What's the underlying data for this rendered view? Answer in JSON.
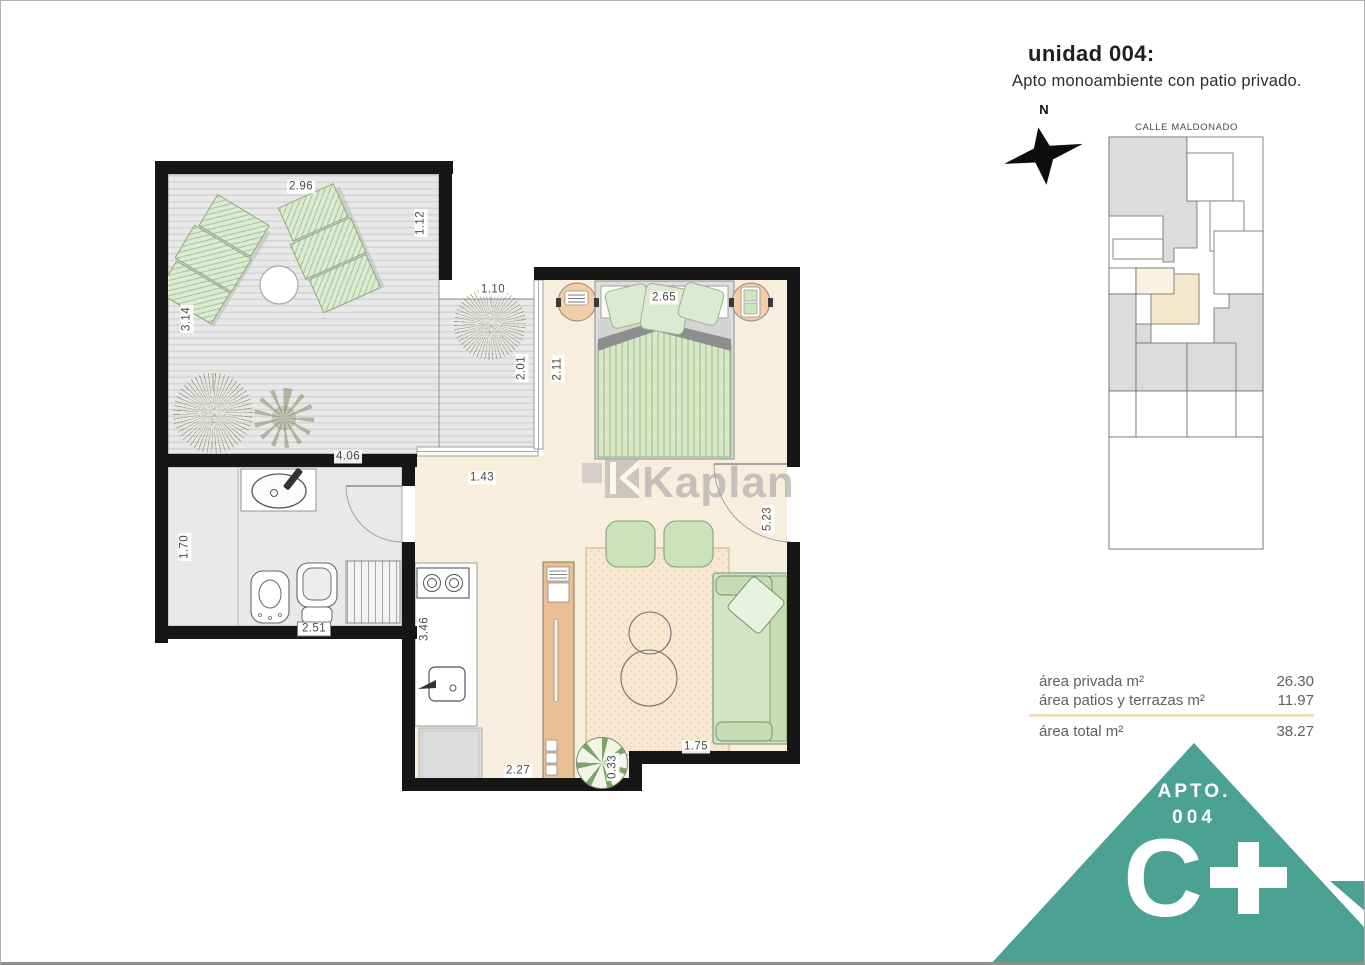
{
  "header": {
    "title": "unidad 004:",
    "subtitle": "Apto monoambiente con patio privado."
  },
  "compass": {
    "north_label": "N"
  },
  "site_plan": {
    "street_label": "CALLE MALDONADO",
    "highlight_color": "#f5e7cc"
  },
  "watermark": {
    "brand": "Kaplan"
  },
  "area_table": {
    "rows": [
      {
        "label": "área privada m²",
        "value": "26.30"
      },
      {
        "label": "área patios y terrazas m²",
        "value": "11.97"
      }
    ],
    "total_row": {
      "label": "área total m²",
      "value": "38.27"
    }
  },
  "badge": {
    "apto_label": "APTO.",
    "unit_number": "004",
    "grade_letter": "C",
    "grade_suffix": "+",
    "accent_color": "#4ba192"
  },
  "floor_plan": {
    "dimensions": {
      "patio_top_width": "2.96",
      "patio_right_step": "1.12",
      "patio_left_height": "3.14",
      "subpatio_width": "1.10",
      "subpatio_height": "2.01",
      "patio_bottom_width": "4.06",
      "bedroom_left_height": "2.11",
      "bed_width": "2.65",
      "hall_width": "1.43",
      "living_right_height": "5.23",
      "bath_left_height": "1.70",
      "bath_bottom_width": "2.51",
      "kitchen_left_height": "3.46",
      "kitchen_bottom_width": "2.27",
      "living_bottom_width": "1.75",
      "planter_width": "0.33"
    },
    "colors": {
      "interior_floor": "#f8eedd",
      "deck": "#e9e9e9",
      "furniture_green": "#d5e6c5",
      "rug": "#f8e8d3",
      "wood": "#e9c094",
      "wall": "#161616"
    }
  }
}
